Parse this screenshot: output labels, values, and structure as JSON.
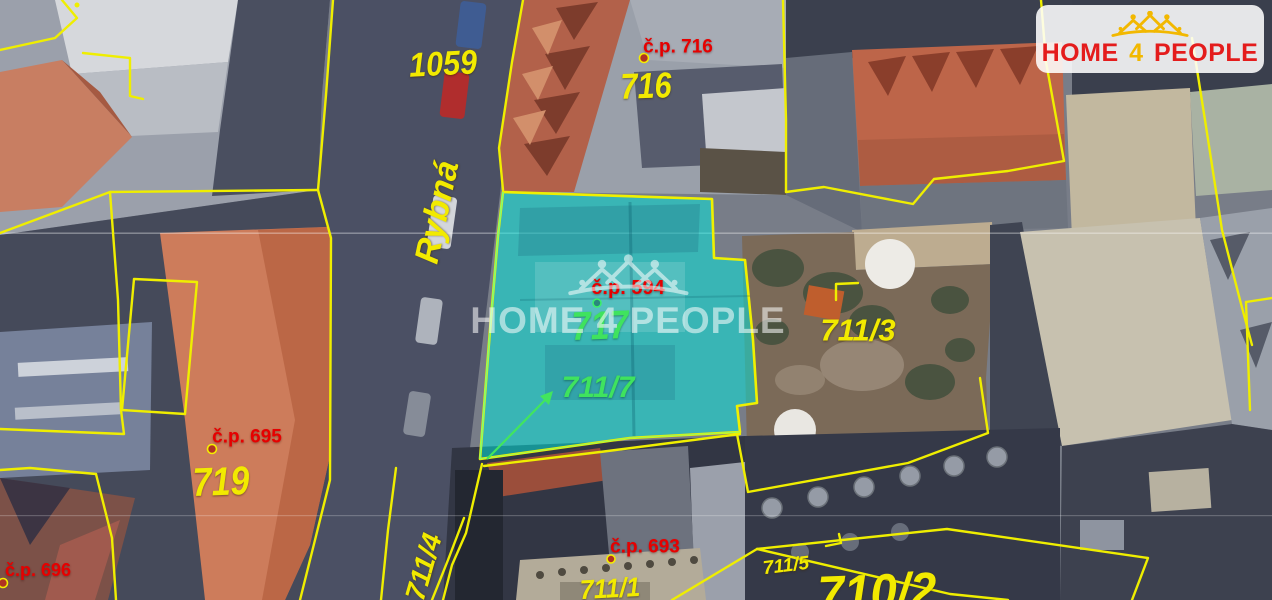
{
  "logo": {
    "home": "HOME",
    "four": "4",
    "people": "PEOPLE"
  },
  "watermark": {
    "brand": "HOME 4 PEOPLE"
  },
  "street": {
    "name": "Rybná"
  },
  "parcel_labels": {
    "p1059": "1059",
    "p716": "716",
    "p717": "717",
    "p711_7": "711/7",
    "p711_3": "711/3",
    "p719": "719",
    "p711_1": "711/1",
    "p711_4": "711/4",
    "p711_5": "711/5",
    "p710_2": "710/2"
  },
  "house_numbers": {
    "cp716": "č.p. 716",
    "cp695": "č.p. 695",
    "cp696": "č.p. 696",
    "cp693": "č.p. 693",
    "cp594": "č.p. 594"
  },
  "colors": {
    "cadastral_line_yellow": "#efee00",
    "parcel_label_yellow": "#f2ea00",
    "house_number_red": "#e60000",
    "highlight_cyan": "#00e8de",
    "highlight_label_green": "#3fe35e",
    "logo_red": "#e41c1c",
    "logo_gold": "#f2b800"
  }
}
